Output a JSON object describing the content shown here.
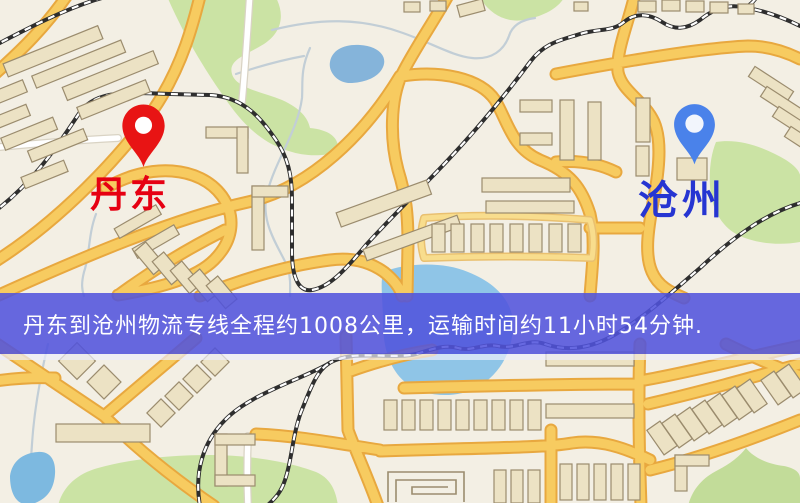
{
  "banner": {
    "text": "丹东到沧州物流专线全程约1008公里，运输时间约11小时54分钟.",
    "bg_color": "#5053dc",
    "text_color": "#ffffff"
  },
  "map": {
    "origin": {
      "label": "丹东",
      "label_color": "#e60012",
      "pin_color": "#e81414"
    },
    "destination": {
      "label": "沧州",
      "label_color": "#2635d2",
      "pin_color": "#4a82ea"
    },
    "palette": {
      "land": "#f3efe4",
      "park": "#cbe3a4",
      "water": "#8fc5e7",
      "lake": "#85b4da",
      "road_fill": "#f7cb60",
      "road_casing": "#e8a83f",
      "railway": "#2e2e2e",
      "building": "#ece2c4"
    }
  }
}
